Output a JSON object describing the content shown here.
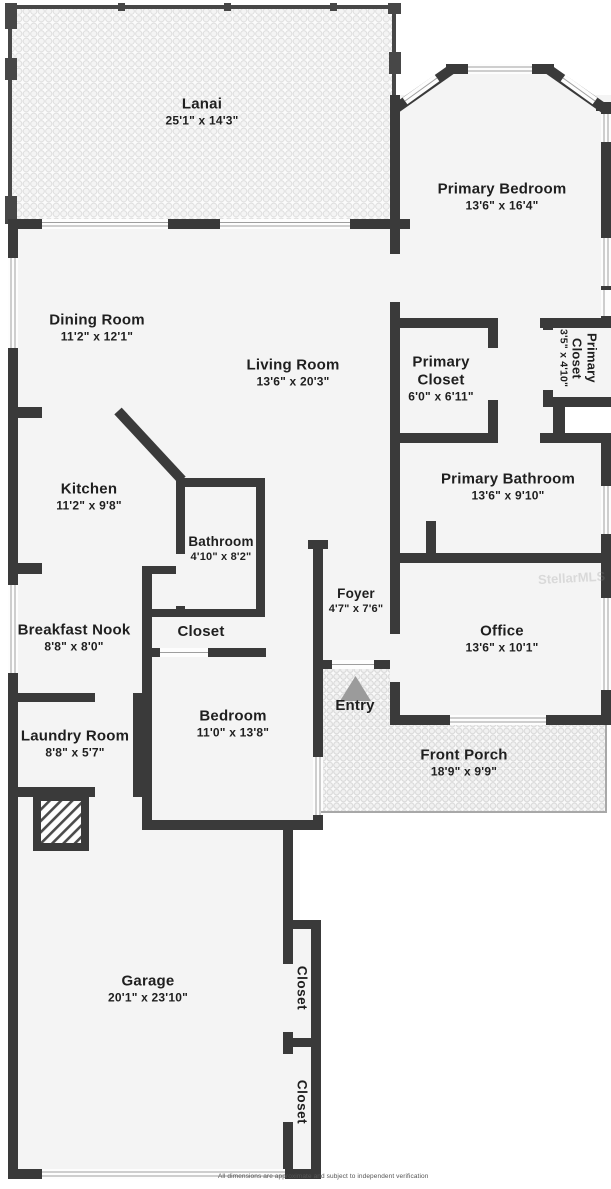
{
  "rooms": [
    {
      "id": "lanai",
      "name": "Lanai",
      "dims": "25'1\" x 14'3\""
    },
    {
      "id": "primary-bedroom",
      "name": "Primary Bedroom",
      "dims": "13'6\" x 16'4\""
    },
    {
      "id": "dining-room",
      "name": "Dining Room",
      "dims": "11'2\" x 12'1\""
    },
    {
      "id": "living-room",
      "name": "Living Room",
      "dims": "13'6\" x 20'3\""
    },
    {
      "id": "primary-closet",
      "name": "Primary Closet",
      "dims": "6'0\" x 6'11\""
    },
    {
      "id": "primary-closet-2",
      "name": "Primary Closet",
      "dims": "3'5\" x 4'10\""
    },
    {
      "id": "kitchen",
      "name": "Kitchen",
      "dims": "11'2\" x 9'8\""
    },
    {
      "id": "primary-bathroom",
      "name": "Primary Bathroom",
      "dims": "13'6\" x 9'10\""
    },
    {
      "id": "bathroom",
      "name": "Bathroom",
      "dims": "4'10\" x 8'2\""
    },
    {
      "id": "foyer",
      "name": "Foyer",
      "dims": "4'7\" x 7'6\""
    },
    {
      "id": "breakfast-nook",
      "name": "Breakfast Nook",
      "dims": "8'8\" x 8'0\""
    },
    {
      "id": "closet-hall",
      "name": "Closet",
      "dims": ""
    },
    {
      "id": "office",
      "name": "Office",
      "dims": "13'6\" x 10'1\""
    },
    {
      "id": "laundry-room",
      "name": "Laundry Room",
      "dims": "8'8\" x 5'7\""
    },
    {
      "id": "bedroom",
      "name": "Bedroom",
      "dims": "11'0\" x 13'8\""
    },
    {
      "id": "entry",
      "name": "Entry",
      "dims": ""
    },
    {
      "id": "front-porch",
      "name": "Front Porch",
      "dims": "18'9\" x 9'9\""
    },
    {
      "id": "garage",
      "name": "Garage",
      "dims": "20'1\" x 23'10\""
    },
    {
      "id": "closet-garage-top",
      "name": "Closet",
      "dims": ""
    },
    {
      "id": "closet-garage-bottom",
      "name": "Closet",
      "dims": ""
    }
  ],
  "watermark": "StellarMLS",
  "disclaimer": "All dimensions are approximate and subject to independent verification",
  "colors": {
    "wall": "#3a3a3a",
    "room_fill": "#f4f4f4",
    "background": "#ffffff",
    "window_line": "#9e9e9e",
    "entry_marker": "#9b9b9b",
    "text": "#1f1f1f"
  }
}
